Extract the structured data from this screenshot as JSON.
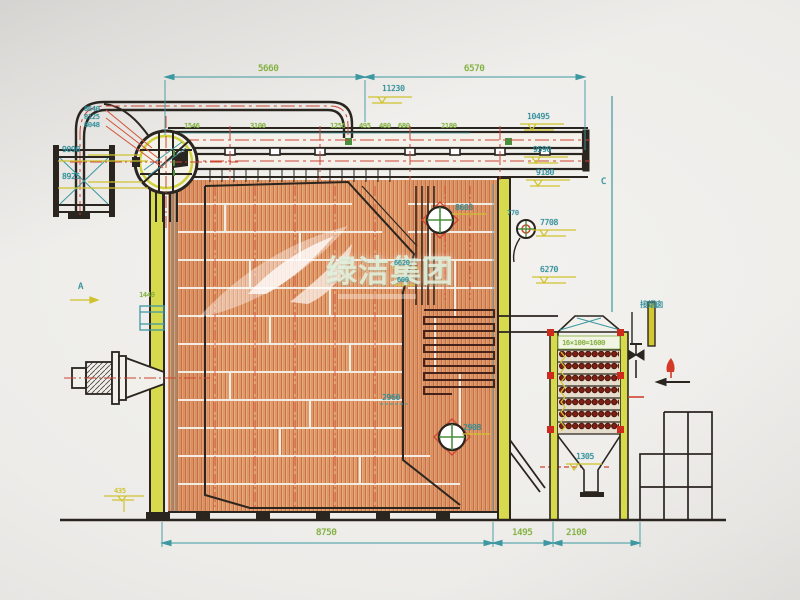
{
  "watermark": {
    "text": "绿洁集团"
  },
  "dims_top": {
    "left": "5660",
    "right": "6570",
    "elev": "11230"
  },
  "header_ticks": {
    "t1": "1546",
    "t2": "3100",
    "t3": "1255",
    "t4": "495",
    "t5": "480",
    "t6": "680",
    "t7": "2180"
  },
  "left_labels": {
    "stack1": "8640",
    "stack2": "8125",
    "stack3": "8048",
    "e9090": "9090",
    "e8925": "8925",
    "marker_a": "A",
    "l1440": "1440",
    "l435": "435"
  },
  "right_labels": {
    "e10495": "10495",
    "e9590": "9590",
    "e9180": "9180",
    "e770": "770",
    "e7708": "7708",
    "e6270": "6270",
    "marker_c": "C",
    "flue": "接烟囱"
  },
  "inner_labels": {
    "l8603": "8603",
    "l2960": "2960",
    "l2908": "2908",
    "l6620": "6620",
    "l600": "600",
    "l1305": "1305",
    "coil_spec": "16×100=1600"
  },
  "dims_bottom": {
    "d1": "8750",
    "d2": "1495",
    "d3": "2100"
  },
  "colors": {
    "dimension_teal": "#2e8d99",
    "text_green": "#7fae3a",
    "level_yellow": "#cfc22e",
    "hatch_orange": "#c4683c",
    "coil_red": "#7c2114",
    "centerline_red": "#cc4433",
    "ink": "#2b2520"
  }
}
